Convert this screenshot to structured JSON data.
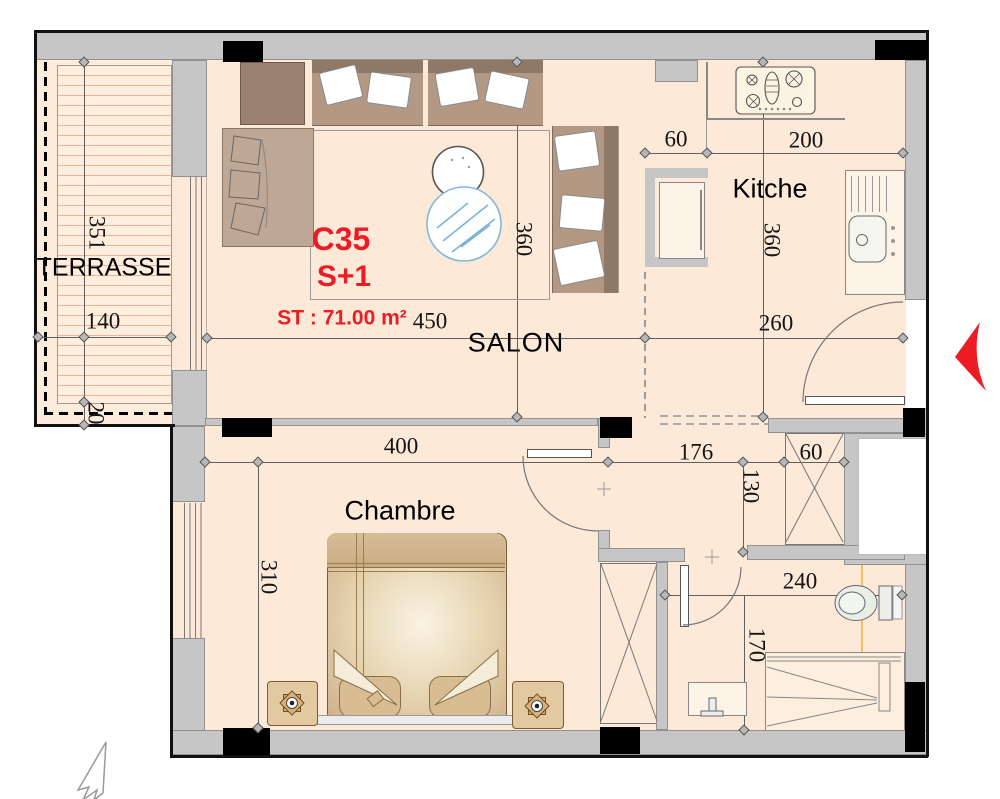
{
  "plan": {
    "unit": {
      "code": "C35",
      "type": "S+1",
      "surface": "ST : 71.00 m²"
    },
    "rooms": {
      "terrasse": "TERRASSE",
      "salon": "SALON",
      "kitchen": "Kitche",
      "bedroom": "Chambre"
    },
    "dimensions": {
      "terrasse_depth": "351",
      "terrasse_width": "140",
      "terrasse_edge": "20",
      "salon_width": "450",
      "salon_depth": "360",
      "kitchen_offset": "60",
      "kitchen_width": "200",
      "kitchen_depth": "360",
      "entry_width": "260",
      "bedroom_width": "400",
      "bedroom_depth": "310",
      "hall_width": "176",
      "hall_depth": "130",
      "hall_closet_width": "60",
      "bath_width": "240",
      "bath_depth": "170"
    },
    "icons": {
      "entrance_arrow": "red-chevron-left",
      "north_arrow": "outline-arrow-northeast",
      "fixtures": [
        "stove-icon",
        "kitchen-sink-icon",
        "toilet-icon",
        "bath-sink-icon",
        "shower-icon",
        "lamp-icon",
        "coffee-table-icon"
      ]
    },
    "colors": {
      "accent_red": "#ed1c24",
      "floor": "#fce9d7",
      "wall_gray": "#c6c6c6",
      "deck_line": "#ecb49a",
      "furniture_brown": "#b39884",
      "bed_tan": "#e8d7b4"
    }
  }
}
